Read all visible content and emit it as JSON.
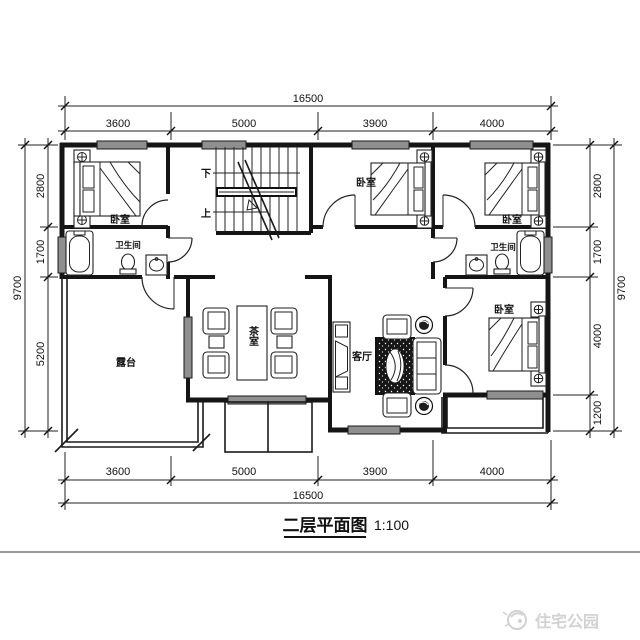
{
  "title": {
    "text": "二层平面图",
    "scale": "1:100"
  },
  "watermark": {
    "brand": "住宅公园"
  },
  "stairs": {
    "down": "下",
    "up": "上"
  },
  "rooms": {
    "bedroom_top_left": "卧室",
    "bedroom_top_mid": "卧室",
    "bedroom_top_right": "卧室",
    "bedroom_bottom_right": "卧室",
    "bathroom_left": "卫生间",
    "bathroom_right": "卫生间",
    "tea_room": "茶室",
    "living_room": "客厅",
    "terrace": "露台"
  },
  "dimensions": {
    "top": {
      "total": "16500",
      "segments": [
        "3600",
        "5000",
        "3900",
        "4000"
      ]
    },
    "bottom": {
      "total": "16500",
      "segments": [
        "3600",
        "5000",
        "3900",
        "4000"
      ]
    },
    "left": {
      "total": "9700",
      "segments": [
        "2800",
        "1700",
        "5200"
      ]
    },
    "right": {
      "total": "9700",
      "segments": [
        "2800",
        "1700",
        "4000",
        "1200"
      ]
    }
  }
}
